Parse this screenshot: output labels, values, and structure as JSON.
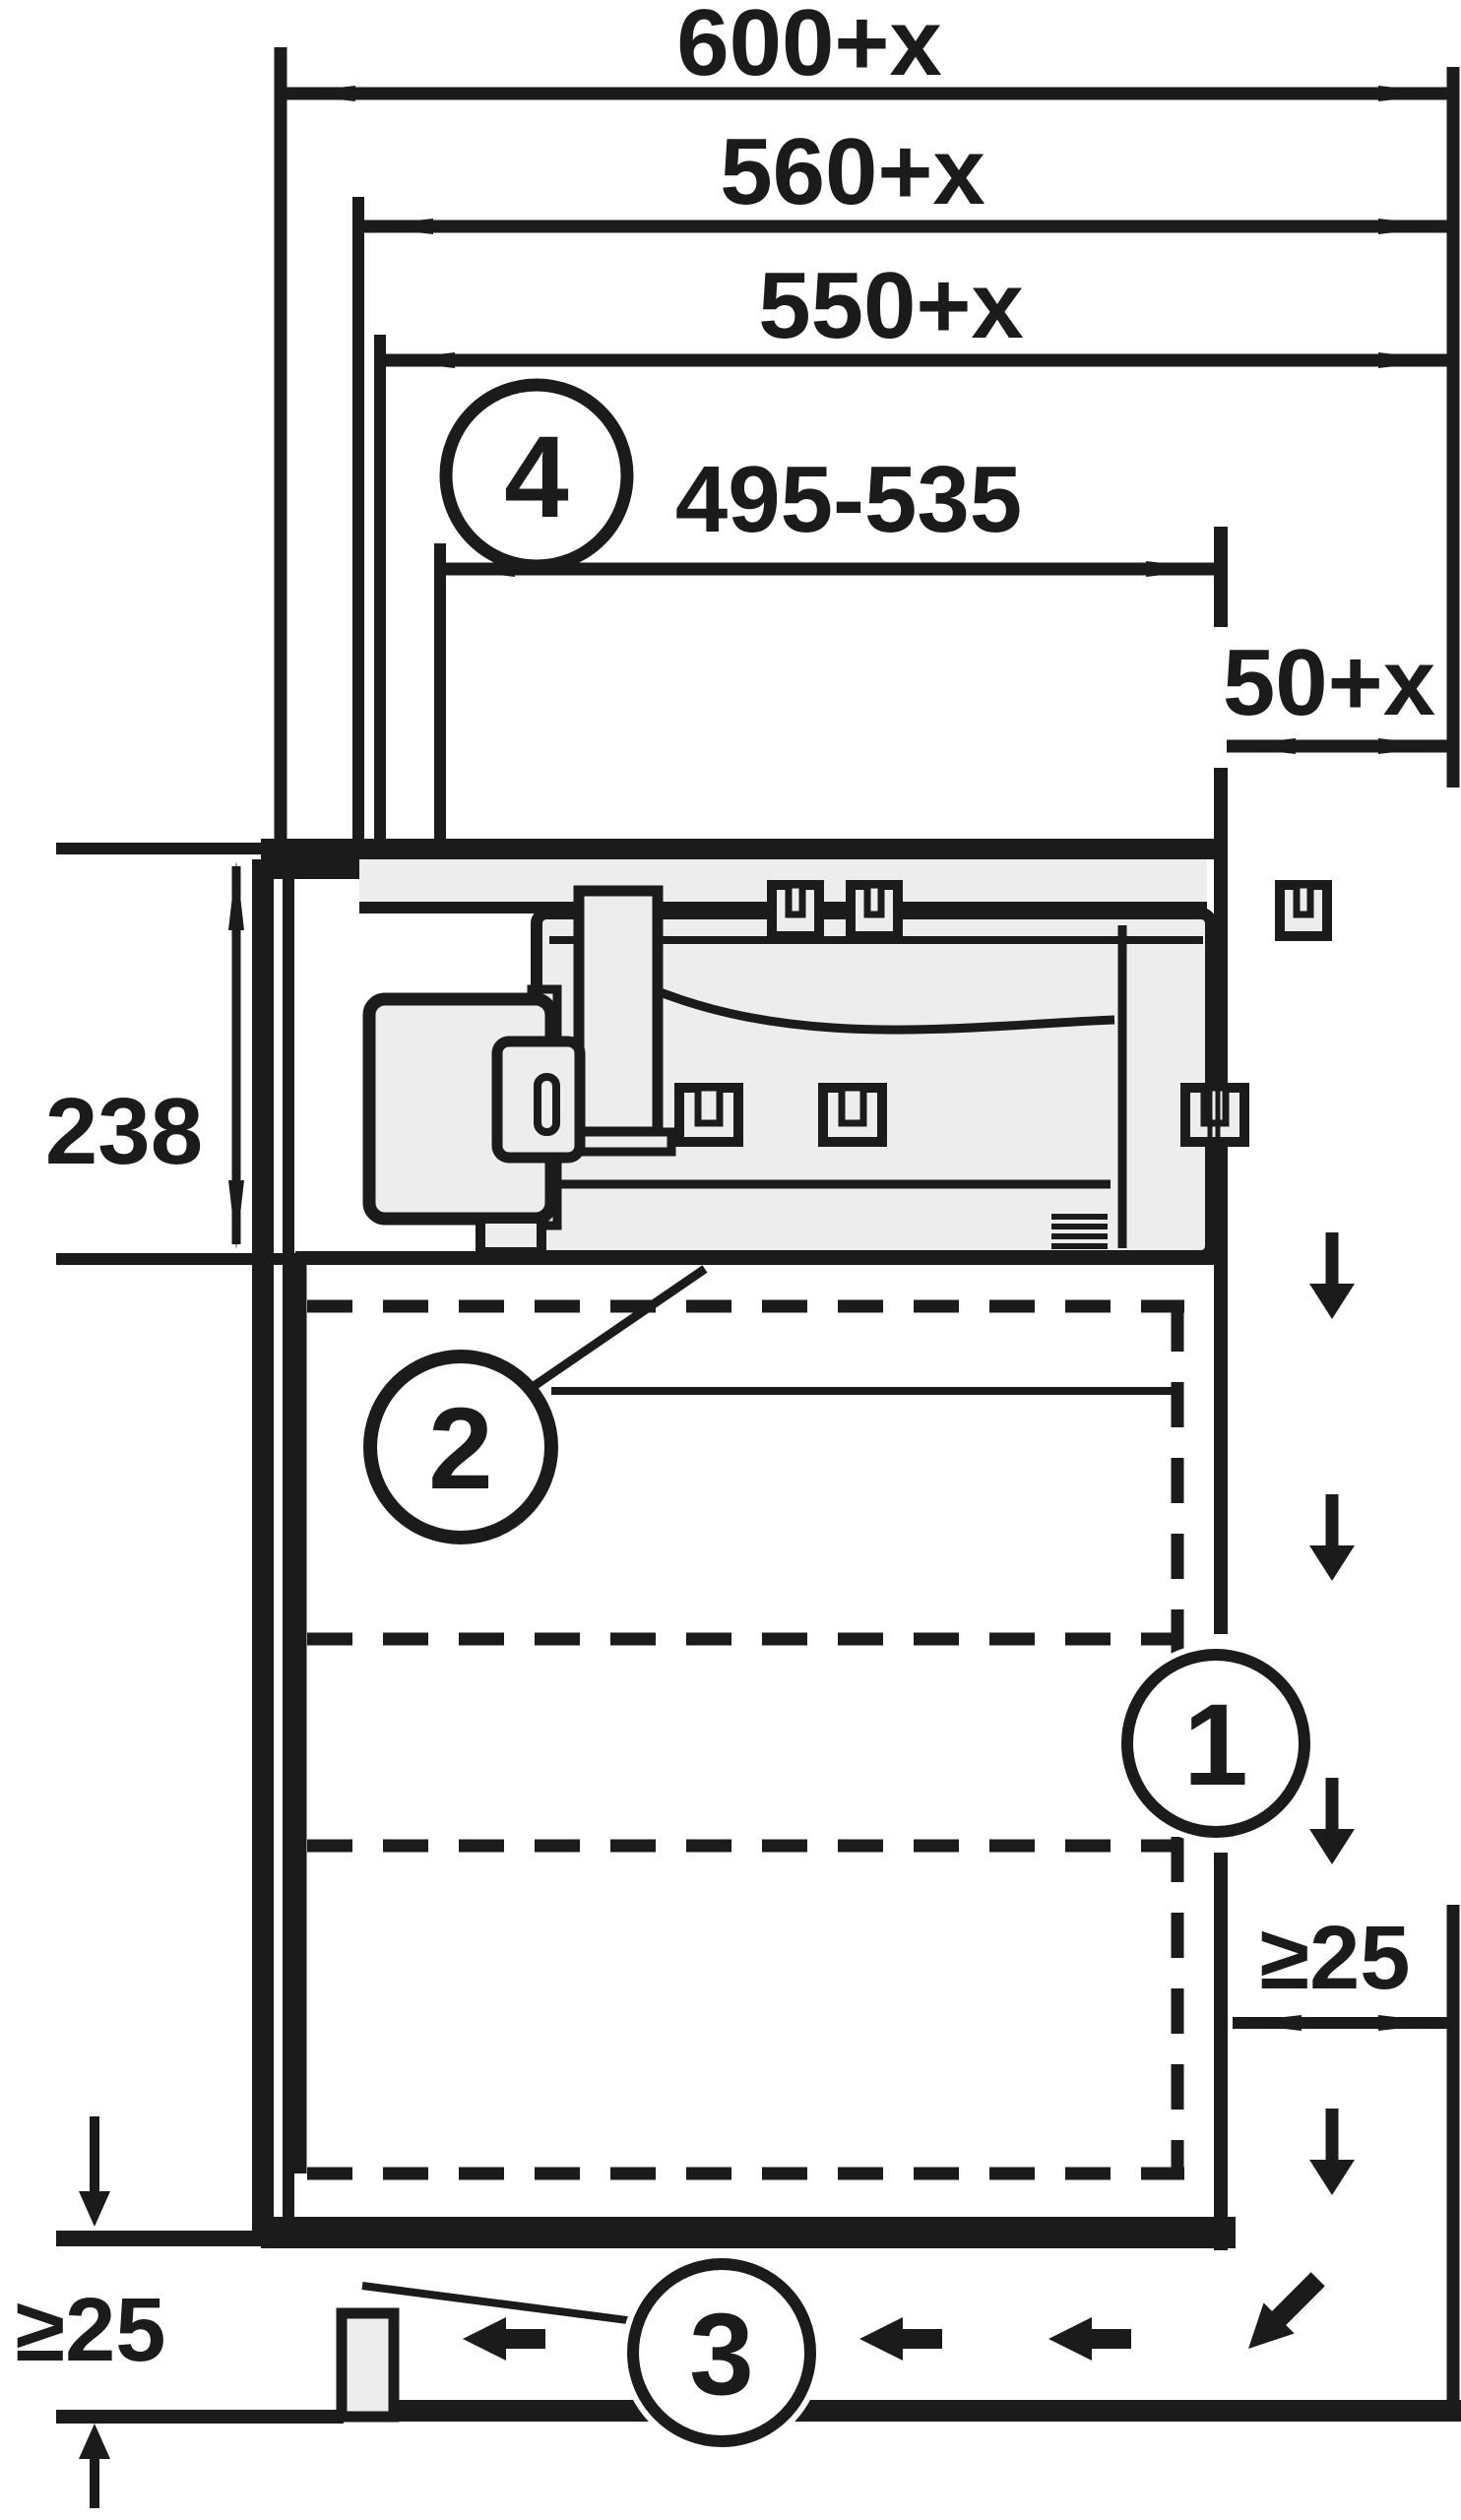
{
  "diagram": {
    "type": "installation-drawing",
    "ink_color": "#1b1b1b",
    "appliance_fill_color": "#ededed",
    "background_color": "#ffffff",
    "dimensions": {
      "niche_top_1": "600+x",
      "niche_top_2": "560+x",
      "niche_top_3": "550+x",
      "cutout_range": "495-535",
      "rear_gap": "50+x",
      "unit_depth_below_worktop": "238",
      "rear_wall_clearance": "≥25",
      "plinth_clearance": "≥25"
    },
    "callouts": {
      "c1": "1",
      "c2": "2",
      "c3": "3",
      "c4": "4"
    },
    "icons": {
      "airflow_down": "down-arrow",
      "airflow_plinth": "left-arrow",
      "airflow_out": "diagonal-arrow"
    }
  }
}
